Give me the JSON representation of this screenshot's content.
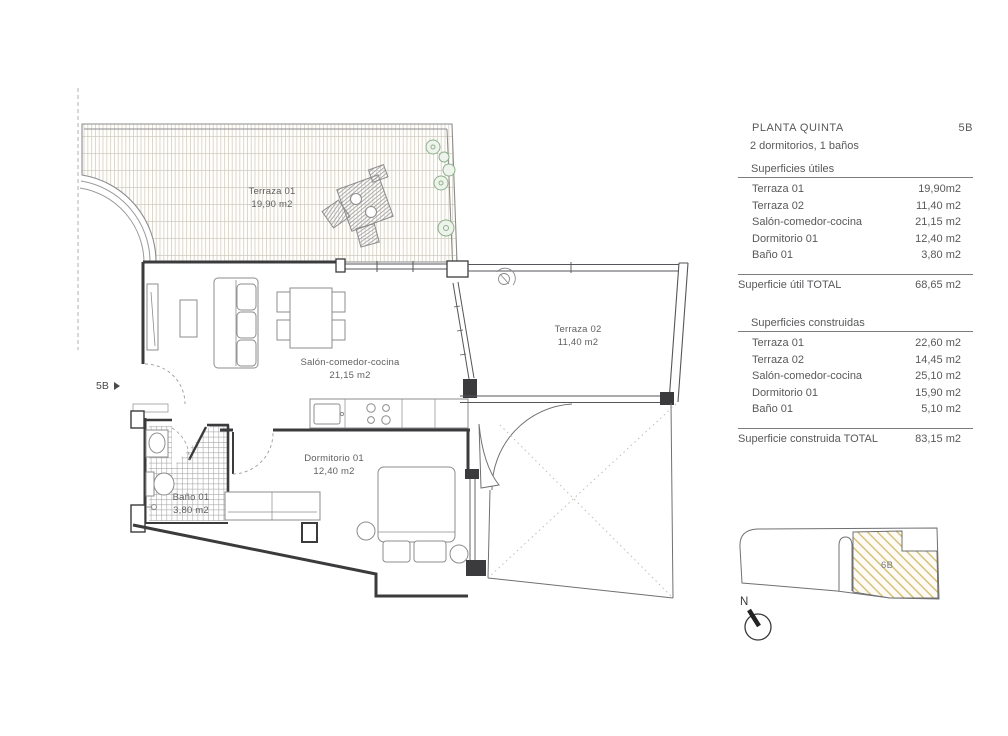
{
  "floor_plan": {
    "unit_label": "5B",
    "rooms": [
      {
        "name": "Terraza 01",
        "area": "19,90 m2"
      },
      {
        "name": "Salón-comedor-cocina",
        "area": "21,15 m2"
      },
      {
        "name": "Terraza 02",
        "area": "11,40 m2"
      },
      {
        "name": "Dormitorio 01",
        "area": "12,40 m2"
      },
      {
        "name": "Baño 01",
        "area": "3,80 m2"
      }
    ]
  },
  "info_panel": {
    "title": "PLANTA QUINTA",
    "unit": "5B",
    "subtitle": "2 dormitorios, 1 baños",
    "useful": {
      "heading": "Superficies útiles",
      "rows": [
        {
          "label": "Terraza 01",
          "value": "19,90m2"
        },
        {
          "label": "Terraza 02",
          "value": "11,40 m2"
        },
        {
          "label": "Salón-comedor-cocina",
          "value": "21,15 m2"
        },
        {
          "label": "Dormitorio 01",
          "value": "12,40 m2"
        },
        {
          "label": "Baño 01",
          "value": "3,80 m2"
        }
      ],
      "total_label": "Superficie útil TOTAL",
      "total_value": "68,65 m2"
    },
    "built": {
      "heading": "Superficies construidas",
      "rows": [
        {
          "label": "Terraza 01",
          "value": "22,60 m2"
        },
        {
          "label": "Terraza 02",
          "value": "14,45 m2"
        },
        {
          "label": "Salón-comedor-cocina",
          "value": "25,10 m2"
        },
        {
          "label": "Dormitorio 01",
          "value": "15,90 m2"
        },
        {
          "label": "Baño 01",
          "value": "5,10 m2"
        }
      ],
      "total_label": "Superficie construida TOTAL",
      "total_value": "83,15 m2"
    }
  },
  "key_plan": {
    "unit_label": "6B"
  },
  "compass": {
    "label": "N"
  },
  "colors": {
    "text": "#58595b",
    "wall": "#3b3b3d",
    "key_hatch": "#d5c07c",
    "plant": "#8fb08c"
  }
}
